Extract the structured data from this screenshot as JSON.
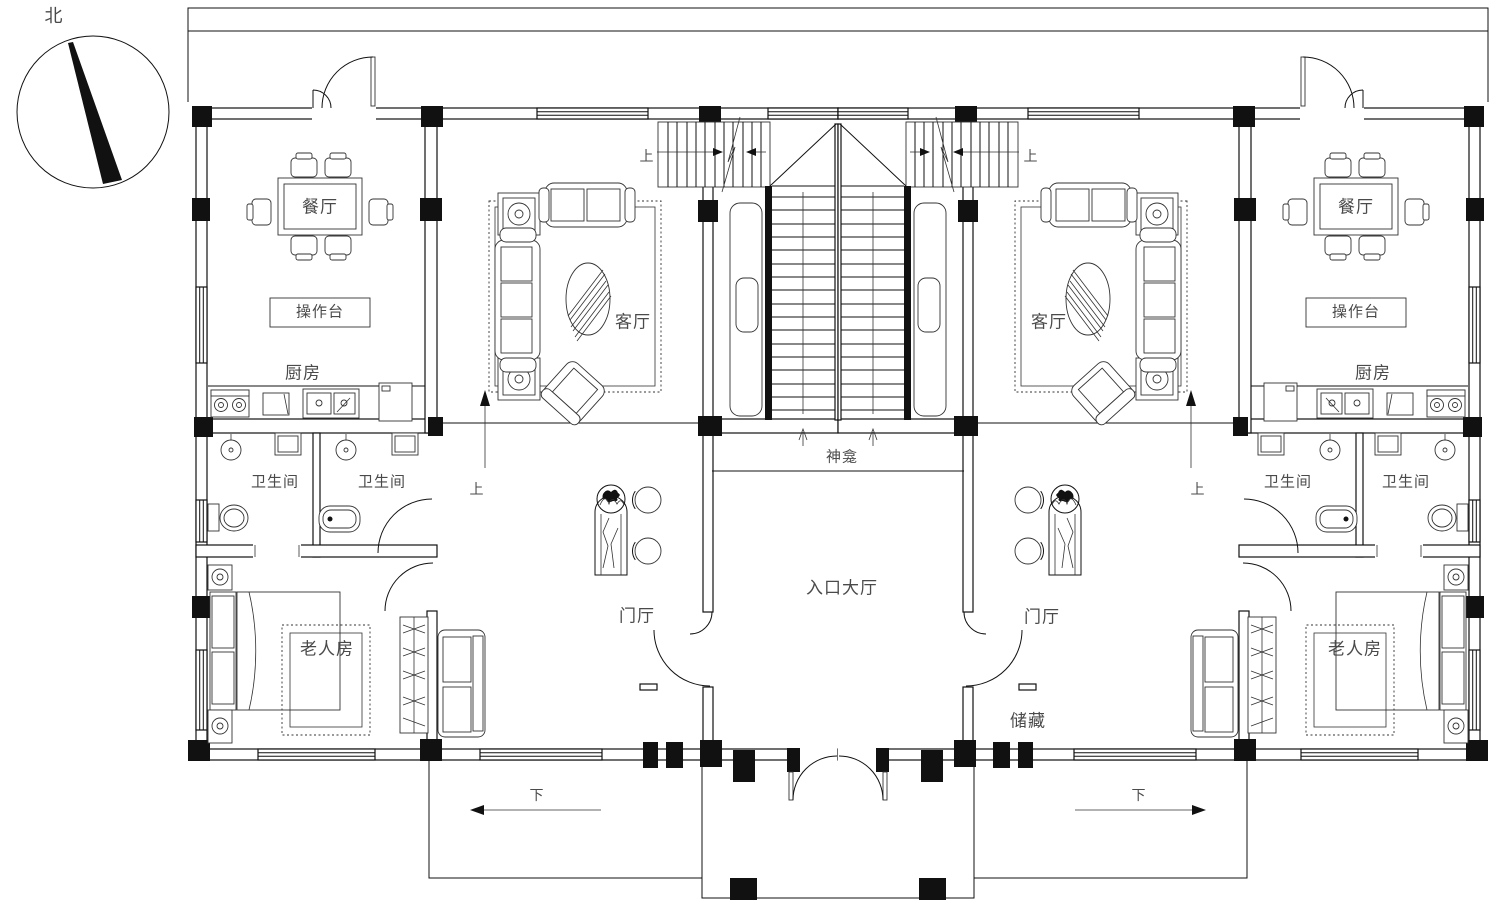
{
  "compass": {
    "north_label": "北"
  },
  "rooms": {
    "dining": "餐厅",
    "counter": "操作台",
    "kitchen": "厨房",
    "living": "客厅",
    "bathroom": "卫生间",
    "elder_bedroom": "老人房",
    "foyer": "门厅",
    "entrance_hall": "入口大厅",
    "shrine": "神龛",
    "storage": "储藏"
  },
  "directions": {
    "up": "上",
    "down": "下"
  },
  "colors": {
    "line": "#111111",
    "label": "#4a4a4a",
    "background": "#ffffff"
  }
}
